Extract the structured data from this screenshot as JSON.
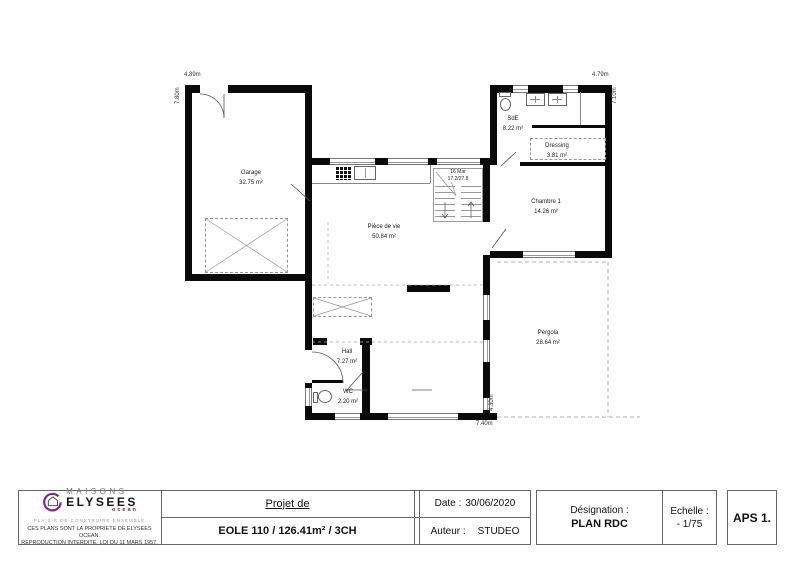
{
  "plan": {
    "rooms": [
      {
        "name": "Garage",
        "area": "32.75 m²"
      },
      {
        "name": "Pièce de vie",
        "area": "50.84 m²"
      },
      {
        "name": "SdE",
        "area": "8.22 m²"
      },
      {
        "name": "Dressing",
        "area": "3.81 m²"
      },
      {
        "name": "Chambre 1",
        "area": "14.26 m²"
      },
      {
        "name": "Pergola",
        "area": "28.64 m²"
      },
      {
        "name": "Hall",
        "area": "7.27 m²"
      },
      {
        "name": "WC",
        "area": "2.20 m²"
      }
    ],
    "stairs": {
      "line1": "16 Mar",
      "line2": "17.2/27.8"
    },
    "dimensions": {
      "top_left": "4.89m",
      "left": "7.80m",
      "top_right": "4.79m",
      "right": "7.10m",
      "bottom": "7.40m",
      "bottom_right": "4.30m"
    }
  },
  "titleblock": {
    "brand": {
      "line1": "MAISONS",
      "line2": "ELYSEES",
      "line3": "ocean",
      "tagline": "PLAISIR DE CONSTRUIRE ENSEMBLE",
      "copyright1": "CES PLANS SONT LA PROPRIETE DE ELYSEES OCEAN.",
      "copyright2": "REPRODUCTION INTERDITE, LOI DU 11 MARS 1957."
    },
    "project": {
      "label": "Projet de",
      "value": "EOLE 110 / 126.41m² / 3CH"
    },
    "date": {
      "label": "Date :",
      "value": "30/06/2020"
    },
    "author": {
      "label": "Auteur :",
      "value": "STUDEO"
    },
    "designation": {
      "label": "Désignation :",
      "value": "PLAN RDC"
    },
    "scale": {
      "label": "Echelle :",
      "value": "- 1/75"
    },
    "stage": "APS 1."
  },
  "colors": {
    "accent_purple": "#7b2c83",
    "brand_red": "#7a2030",
    "wall": "#0a0a0a"
  }
}
